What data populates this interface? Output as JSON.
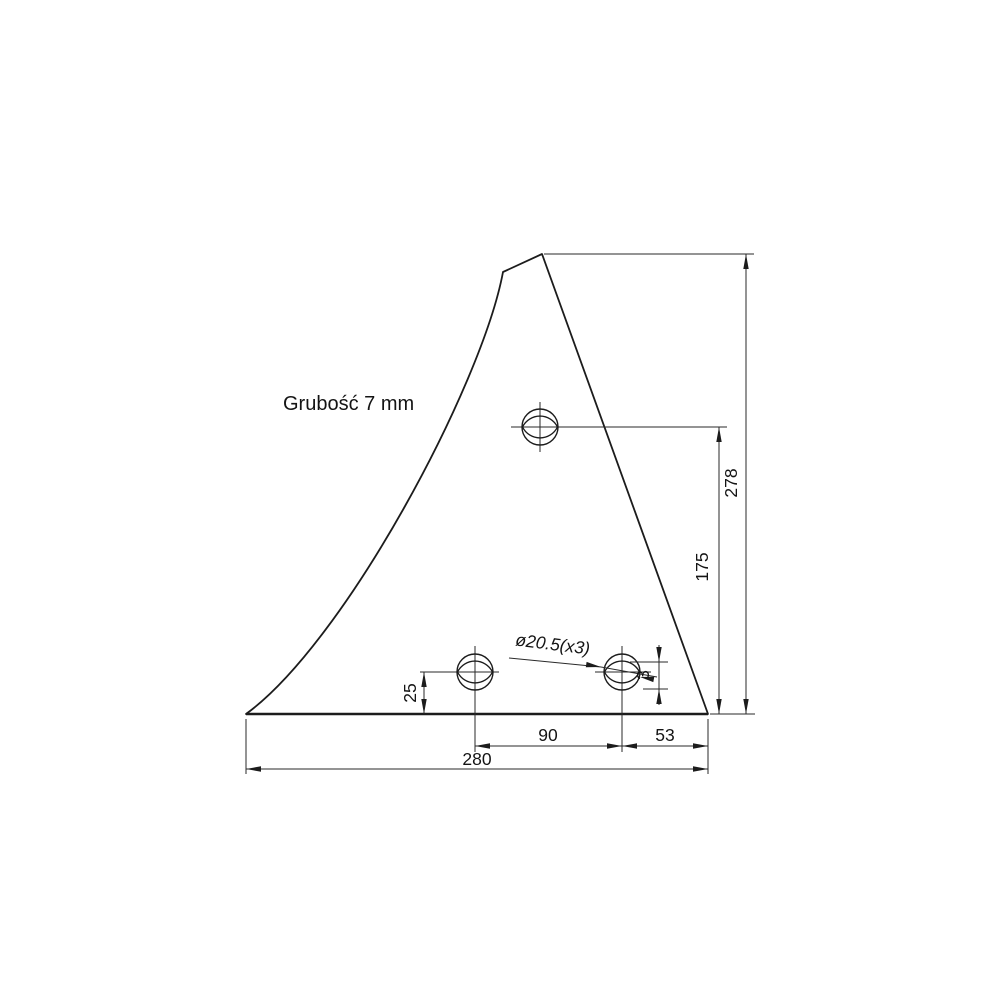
{
  "drawing": {
    "note": "Grubość 7 mm",
    "hole_callout": "ø20.5(x3)",
    "dimensions": {
      "total_width": "280",
      "hole_spacing": "90",
      "right_offset": "53",
      "bottom_hole_height": "25",
      "top_hole_height": "175",
      "total_height": "278",
      "small_offset": "3"
    },
    "colors": {
      "line_color": "#1c1c1c",
      "background": "#ffffff"
    }
  }
}
